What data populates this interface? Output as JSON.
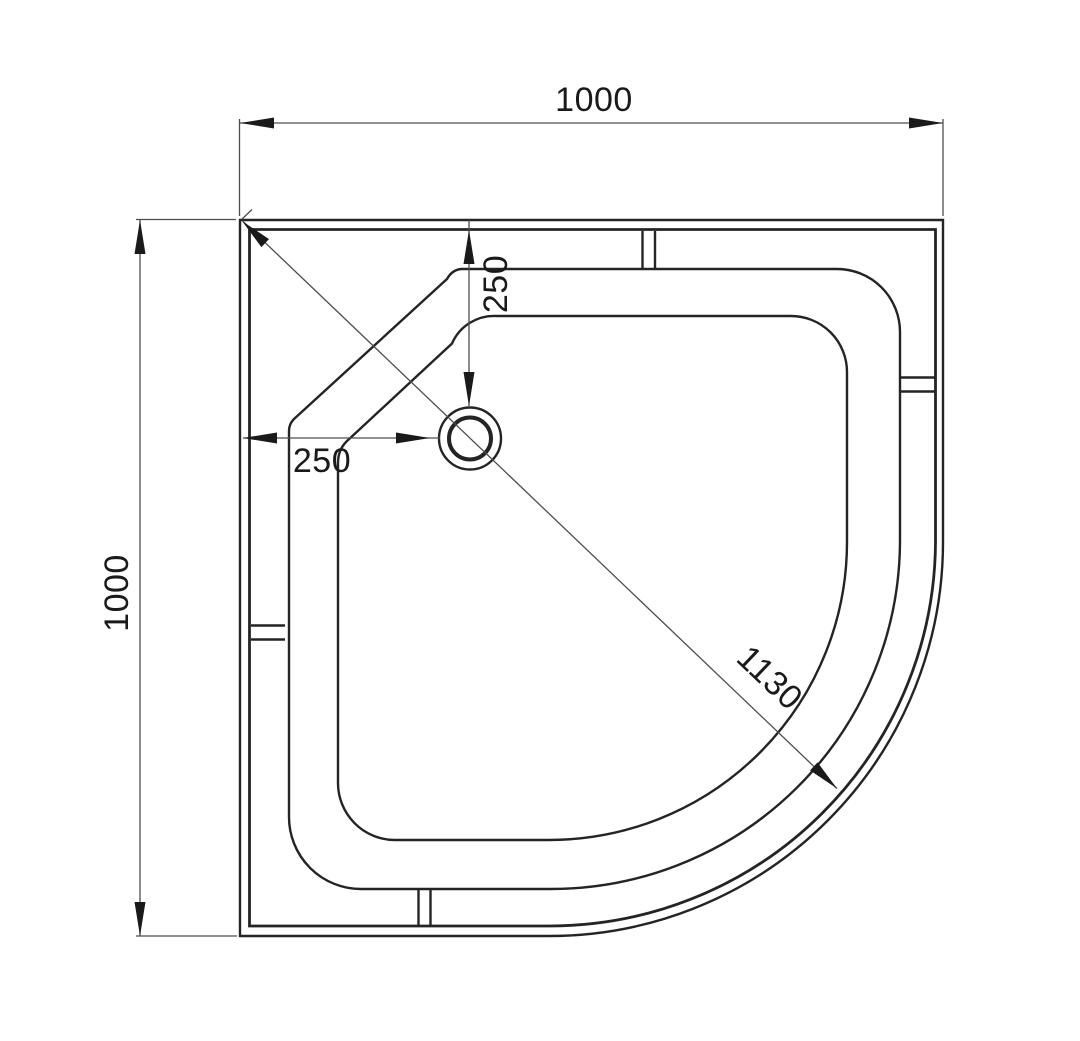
{
  "drawing": {
    "type": "technical drawing",
    "subject": "quadrant shower tray - top view plan",
    "background_color": "#ffffff",
    "geometry_line_color": "#242424",
    "dimension_line_color": "#4d4d4d",
    "text_color": "#1a1a1a",
    "labels": {
      "overall_width": "1000",
      "overall_depth": "1000",
      "drain_offset_horizontal": "250",
      "drain_offset_vertical": "250",
      "diagonal": "1130"
    }
  }
}
